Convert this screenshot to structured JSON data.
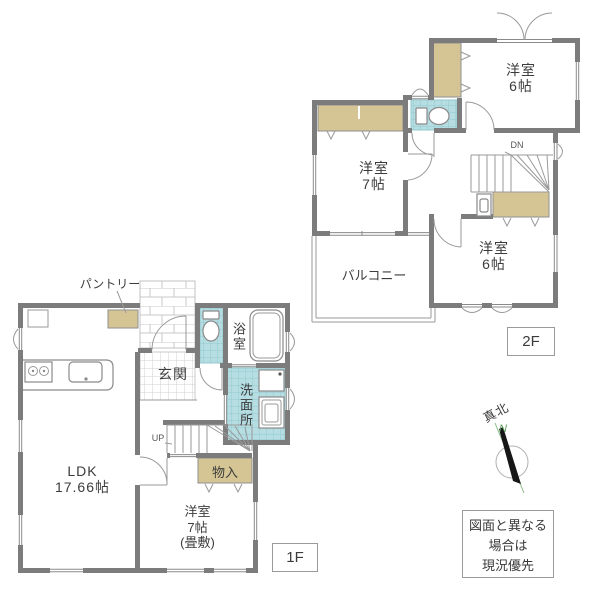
{
  "floor2": {
    "tag": "2F",
    "room_top": {
      "name": "洋室",
      "size": "6帖"
    },
    "room_left": {
      "name": "洋室",
      "size": "7帖"
    },
    "room_bottom": {
      "name": "洋室",
      "size": "6帖"
    },
    "balcony": "バルコニー",
    "stairs": "DN"
  },
  "floor1": {
    "tag": "1F",
    "ldk": {
      "name": "LDK",
      "size": "17.66帖"
    },
    "entrance": "玄関",
    "bathroom": "浴室",
    "washroom": "洗面所",
    "pantry": "パントリー",
    "storage": "物入",
    "tatami_room": {
      "name": "洋室",
      "size": "7帖",
      "note": "(畳敷)"
    },
    "stairs": "UP"
  },
  "compass": {
    "title": "真北",
    "north": "N"
  },
  "disclaimer": {
    "line1": "図面と異なる",
    "line2": "場合は",
    "line3": "現況優先"
  },
  "colors": {
    "wall": "#7c7c7c",
    "closet": "#d5c494",
    "wet_area": "#b5dde2",
    "tile_line": "#93c9cf",
    "compass_green": "#5d9b5d"
  }
}
